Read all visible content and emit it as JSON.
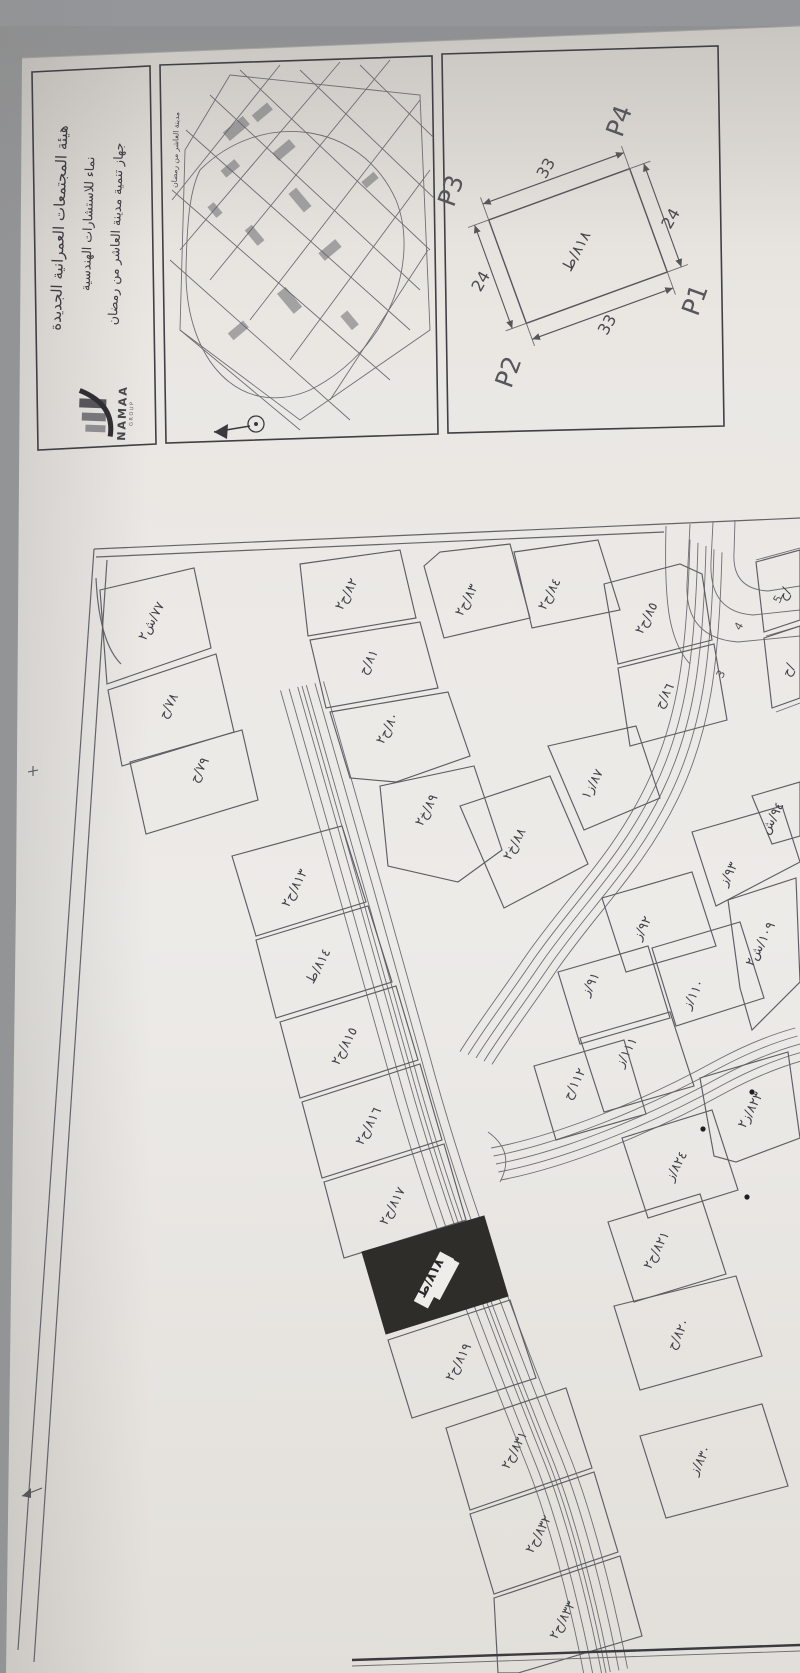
{
  "photo": {
    "background": "#94969a",
    "paper_base": "#e9e6e2",
    "line_color": "#5f5f64",
    "text_color": "#3c3c41",
    "highlight_plot_color": "#2f2d2a"
  },
  "header": {
    "org_lines": [
      "هيئة المجتمعات العمرانية الجديدة",
      "نماء للاستشارات الهندسية",
      "جهاز تنمية مدينة العاشر من رمضان"
    ],
    "logo": {
      "brand": "NAMAA",
      "sub": "GROUP"
    }
  },
  "key_map": {
    "caption": "مدينة العاشر من رمضان"
  },
  "detail_diagram": {
    "corners": {
      "p1": "P1",
      "p2": "P2",
      "p3": "P3",
      "p4": "P4"
    },
    "dim_top": "33",
    "dim_bottom": "33",
    "dim_left": "24",
    "dim_right": "24",
    "plot_label": "٨١٨/ط"
  },
  "map": {
    "road_numbers": [
      {
        "t": "3",
        "x": 724,
        "y": 676
      },
      {
        "t": "4",
        "x": 742,
        "y": 628
      },
      {
        "t": "5",
        "x": 781,
        "y": 601
      }
    ],
    "plots": [
      {
        "label": "٧٧/ش٢",
        "pts": "100,590 194,568 211,648 107,684",
        "lx": 155,
        "ly": 623
      },
      {
        "label": "٧٨/ح",
        "pts": "108,690 216,654 234,732 122,766",
        "lx": 172,
        "ly": 708
      },
      {
        "label": "٧٩/ح",
        "pts": "130,762 242,730 258,800 146,834",
        "lx": 203,
        "ly": 772
      },
      {
        "label": "٨٢/ح٢",
        "pts": "300,564 400,550 416,618 308,636",
        "lx": 350,
        "ly": 596
      },
      {
        "label": "٨١/ح",
        "pts": "310,640 420,622 438,688 326,708",
        "lx": 372,
        "ly": 664
      },
      {
        "label": "٨٠/ح٢",
        "pts": "330,712 448,692 470,756 396,782 350,778",
        "lx": 391,
        "ly": 730
      },
      {
        "label": "٨٣/ح٢",
        "pts": "424,566 440,552 510,544 530,618 444,638",
        "lx": 470,
        "ly": 602
      },
      {
        "label": "٨٤/ح٢",
        "pts": "514,552 598,540 620,610 532,628",
        "lx": 553,
        "ly": 596
      },
      {
        "label": "٨٥/ح٢",
        "pts": "604,584 680,564 702,574 712,640 618,664",
        "lx": 650,
        "ly": 620
      },
      {
        "label": "٨٦/ح",
        "pts": "618,668 714,644 727,720 630,746",
        "lx": 668,
        "ly": 698
      },
      {
        "label": "٨٩/خ٢",
        "pts": "380,786 474,766 502,850 458,882 388,866",
        "lx": 430,
        "ly": 812
      },
      {
        "label": "٨٨/خ٢",
        "pts": "460,806 550,776 588,864 504,908",
        "lx": 518,
        "ly": 846
      },
      {
        "label": "٨٧/ز١",
        "pts": "548,746 636,726 660,798 584,830",
        "lx": 596,
        "ly": 786
      },
      {
        "label": "٩٣/ز",
        "pts": "692,832 782,806 800,862 716,906",
        "lx": 732,
        "ly": 876
      },
      {
        "label": "٩٤/ش",
        "pts": "752,796 800,782 800,836 772,844",
        "lx": 776,
        "ly": 820
      },
      {
        "label": "٩٢/ز",
        "pts": "602,898 692,872 716,946 626,972",
        "lx": 646,
        "ly": 930
      },
      {
        "label": "٩١/ز",
        "pts": "558,972 648,946 670,1018 580,1044",
        "lx": 594,
        "ly": 986
      },
      {
        "label": "١١٠/ز",
        "pts": "652,948 740,922 764,998 676,1026",
        "lx": 697,
        "ly": 996
      },
      {
        "label": "١٠٩/ش٢",
        "pts": "728,900 796,878 800,982 752,1030 740,988",
        "lx": 764,
        "ly": 946
      },
      {
        "label": "١١١/ز",
        "pts": "580,1038 670,1012 694,1086 604,1112",
        "lx": 630,
        "ly": 1054
      },
      {
        "label": "١١٢/ح",
        "pts": "534,1066 624,1040 646,1114 556,1140",
        "lx": 578,
        "ly": 1086
      },
      {
        "label": "٨١٣/ح٢",
        "pts": "232,856 342,826 366,902 256,936",
        "lx": 298,
        "ly": 890
      },
      {
        "label": "٨١٤/ط",
        "pts": "256,940 368,906 392,982 276,1018",
        "lx": 322,
        "ly": 968
      },
      {
        "label": "٨١٥/ح٢",
        "pts": "280,1022 396,986 418,1060 300,1098",
        "lx": 348,
        "ly": 1048
      },
      {
        "label": "٨١٦/ح٢",
        "pts": "302,1102 420,1064 442,1140 322,1178",
        "lx": 372,
        "ly": 1128
      },
      {
        "label": "٨١٧/ح٢",
        "pts": "324,1182 444,1144 466,1220 344,1258",
        "lx": 396,
        "ly": 1208
      },
      {
        "label": "٨١٨/ط",
        "pts": "362,1252 484,1216 508,1296 386,1334",
        "lx": 434,
        "ly": 1280,
        "dark": true
      },
      {
        "label": "٨١٩/ح٢",
        "pts": "388,1340 510,1300 536,1378 412,1418",
        "lx": 462,
        "ly": 1364
      },
      {
        "label": "٨٣١/ح٢",
        "pts": "446,1428 566,1388 592,1468 470,1510",
        "lx": 518,
        "ly": 1452
      },
      {
        "label": "٨٣٢/ح٢",
        "pts": "470,1514 594,1472 618,1552 494,1594",
        "lx": 542,
        "ly": 1536
      },
      {
        "label": "٨٣٣/ح٢",
        "pts": "494,1598 620,1556 642,1636 518,1673 498,1673",
        "lx": 566,
        "ly": 1622
      },
      {
        "label": "٨٢٤/ز",
        "pts": "622,1138 712,1110 738,1190 648,1218",
        "lx": 680,
        "ly": 1168
      },
      {
        "label": "٨٢٣/ز٢",
        "pts": "700,1078 788,1052 800,1138 736,1162 714,1156",
        "lx": 754,
        "ly": 1112
      },
      {
        "label": "٨٢١/ح٢",
        "pts": "608,1222 700,1194 726,1274 634,1302",
        "lx": 660,
        "ly": 1252
      },
      {
        "label": "٨٢٠/ح",
        "pts": "614,1306 736,1276 762,1356 640,1390",
        "lx": 682,
        "ly": 1336
      },
      {
        "label": "٨٣٠/ز",
        "pts": "640,1436 762,1404 788,1486 666,1518",
        "lx": 704,
        "ly": 1462
      },
      {
        "label": "/ح",
        "pts": "756,562 800,550 800,620 764,632",
        "lx": 788,
        "ly": 596
      },
      {
        "label": "/ح",
        "pts": "764,638 800,626 800,698 772,708",
        "lx": 792,
        "ly": 672
      }
    ]
  }
}
